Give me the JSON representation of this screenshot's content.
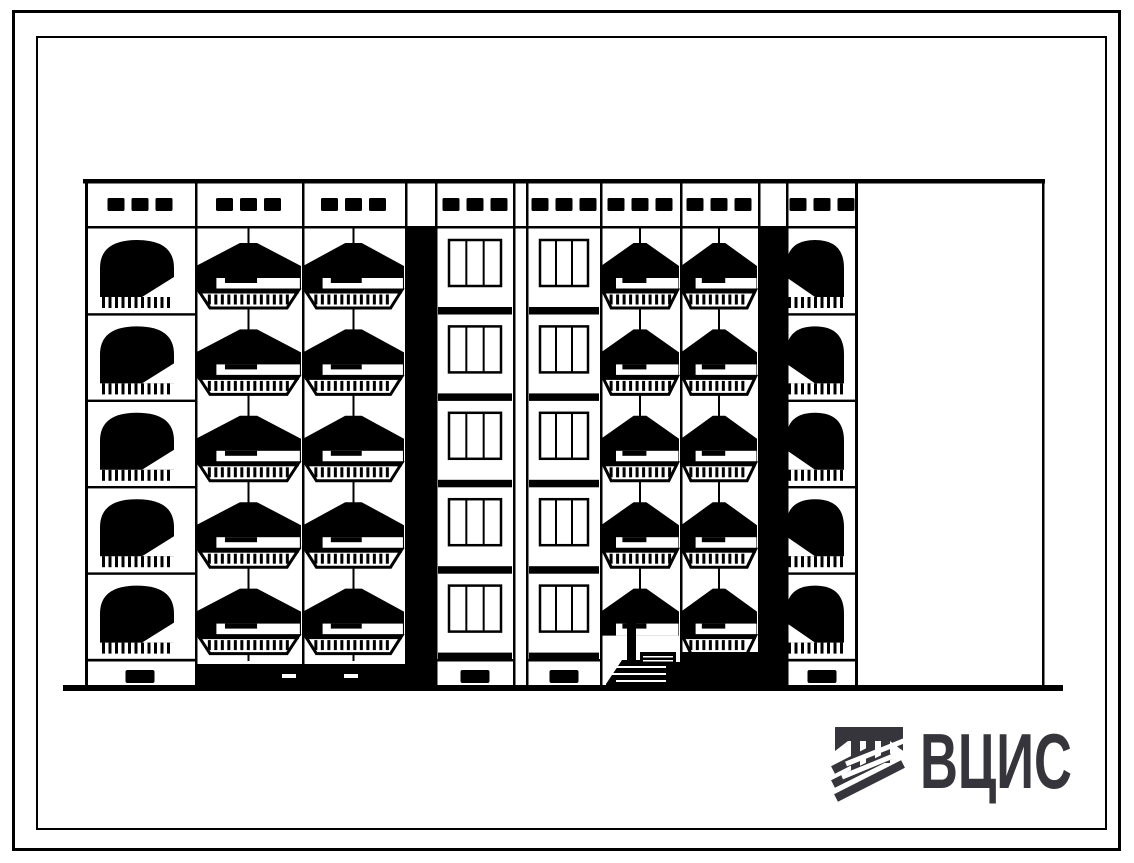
{
  "sheet": {
    "kind": "scanned typical-design drawing sheet",
    "background": "#ffffff",
    "ink": "#000000"
  },
  "logo": {
    "text": "ВЦИС",
    "color": "#35353b",
    "icon": "hatched-beam-and-columns-mark"
  },
  "facade": {
    "description": "end elevation of 5-storey large-panel residential block",
    "floors": 5,
    "attic_vents_per_bay": 3,
    "body": {
      "left": 85,
      "right": 858,
      "top": 180,
      "attic_bottom": 228,
      "cells_bottom": 660,
      "ground": 687
    },
    "extension": {
      "left": 858,
      "right": 1042
    },
    "ground_line": {
      "x1": 63,
      "x2": 1063,
      "y": 685
    },
    "left_block_ground_shadow": {
      "x": 196,
      "w": 224,
      "y": 664,
      "h": 23
    },
    "bays": [
      {
        "id": "bay-1",
        "type": "arched-balconies",
        "x": 85,
        "w": 110,
        "notch": "right",
        "basement_vent": true
      },
      {
        "id": "bay-2",
        "type": "canopy-balconies",
        "x": 195,
        "w": 107
      },
      {
        "id": "bay-3",
        "type": "canopy-balconies",
        "x": 302,
        "w": 103
      },
      {
        "id": "shadow-band-1",
        "type": "shadow-band",
        "x": 405,
        "w": 32
      },
      {
        "id": "bay-4",
        "type": "windows",
        "x": 437,
        "w": 76,
        "basement_vent": true
      },
      {
        "id": "block-joint",
        "type": "joint",
        "x": 513,
        "w": 15
      },
      {
        "id": "bay-5",
        "type": "windows",
        "x": 528,
        "w": 72,
        "basement_vent": true
      },
      {
        "id": "bay-6",
        "type": "canopy-balconies",
        "x": 600,
        "w": 80,
        "entrance": true
      },
      {
        "id": "bay-7",
        "type": "canopy-balconies",
        "x": 680,
        "w": 78,
        "ground_shadow": true
      },
      {
        "id": "shadow-band-2",
        "type": "shadow-band",
        "x": 758,
        "w": 28
      },
      {
        "id": "bay-8",
        "type": "arched-balconies",
        "x": 786,
        "w": 72,
        "notch": "left",
        "basement_vent": true
      }
    ],
    "entrance": {
      "posts": [
        [
          627,
          617,
          9,
          70
        ],
        [
          696,
          617,
          9,
          70
        ]
      ],
      "door_fill": [
        636,
        662,
        60,
        25
      ],
      "sign": [
        640,
        652,
        36,
        14
      ],
      "steps": [
        [
          606,
          687
        ],
        [
          606,
          684
        ],
        [
          622,
          660
        ],
        [
          668,
          660
        ],
        [
          668,
          687
        ]
      ]
    }
  }
}
